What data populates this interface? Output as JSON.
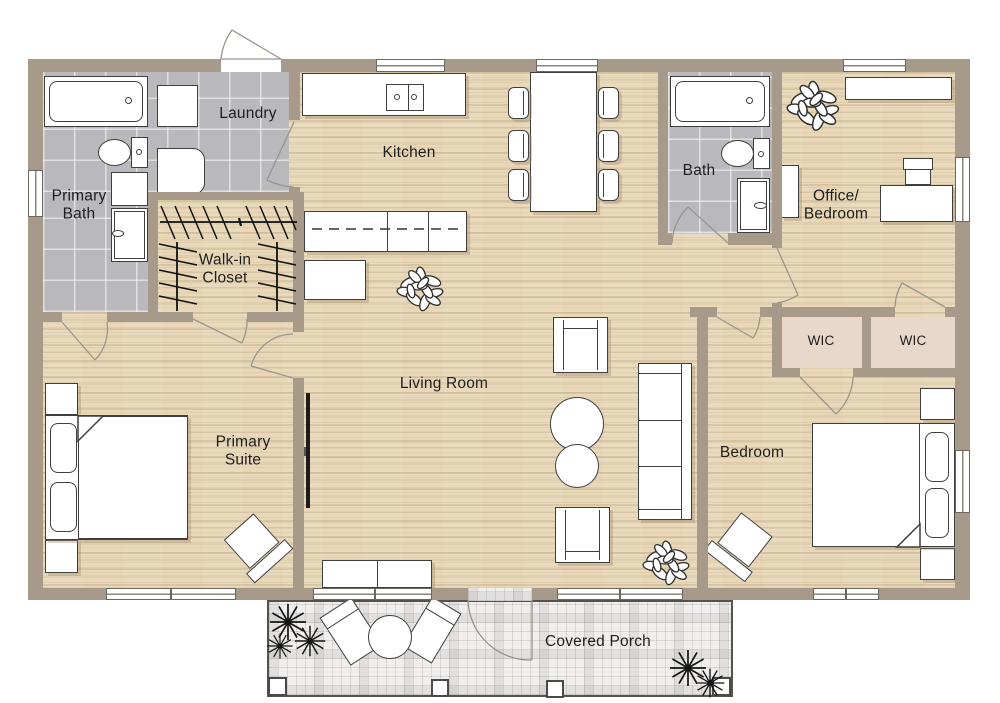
{
  "floorplan": {
    "labels": {
      "primary_bath": [
        "Primary",
        "Bath"
      ],
      "laundry": "Laundry",
      "kitchen": "Kitchen",
      "bath": "Bath",
      "office_bedroom": [
        "Office/",
        "Bedroom"
      ],
      "walk_in_closet": [
        "Walk-in",
        "Closet"
      ],
      "living_room": "Living Room",
      "primary_suite": [
        "Primary",
        "Suite"
      ],
      "bedroom": "Bedroom",
      "wic_left": "WIC",
      "wic_right": "WIC",
      "covered_porch": "Covered Porch"
    },
    "colors": {
      "wall": "#a89a8a",
      "wood_floor": "#e8d8b9",
      "bath_tile": "#b9b9bd",
      "wic_floor": "#e9d8ca",
      "porch_tile": "#f0efed",
      "furniture_outline": "#3f3f3f",
      "text": "#1e1e1e"
    }
  }
}
